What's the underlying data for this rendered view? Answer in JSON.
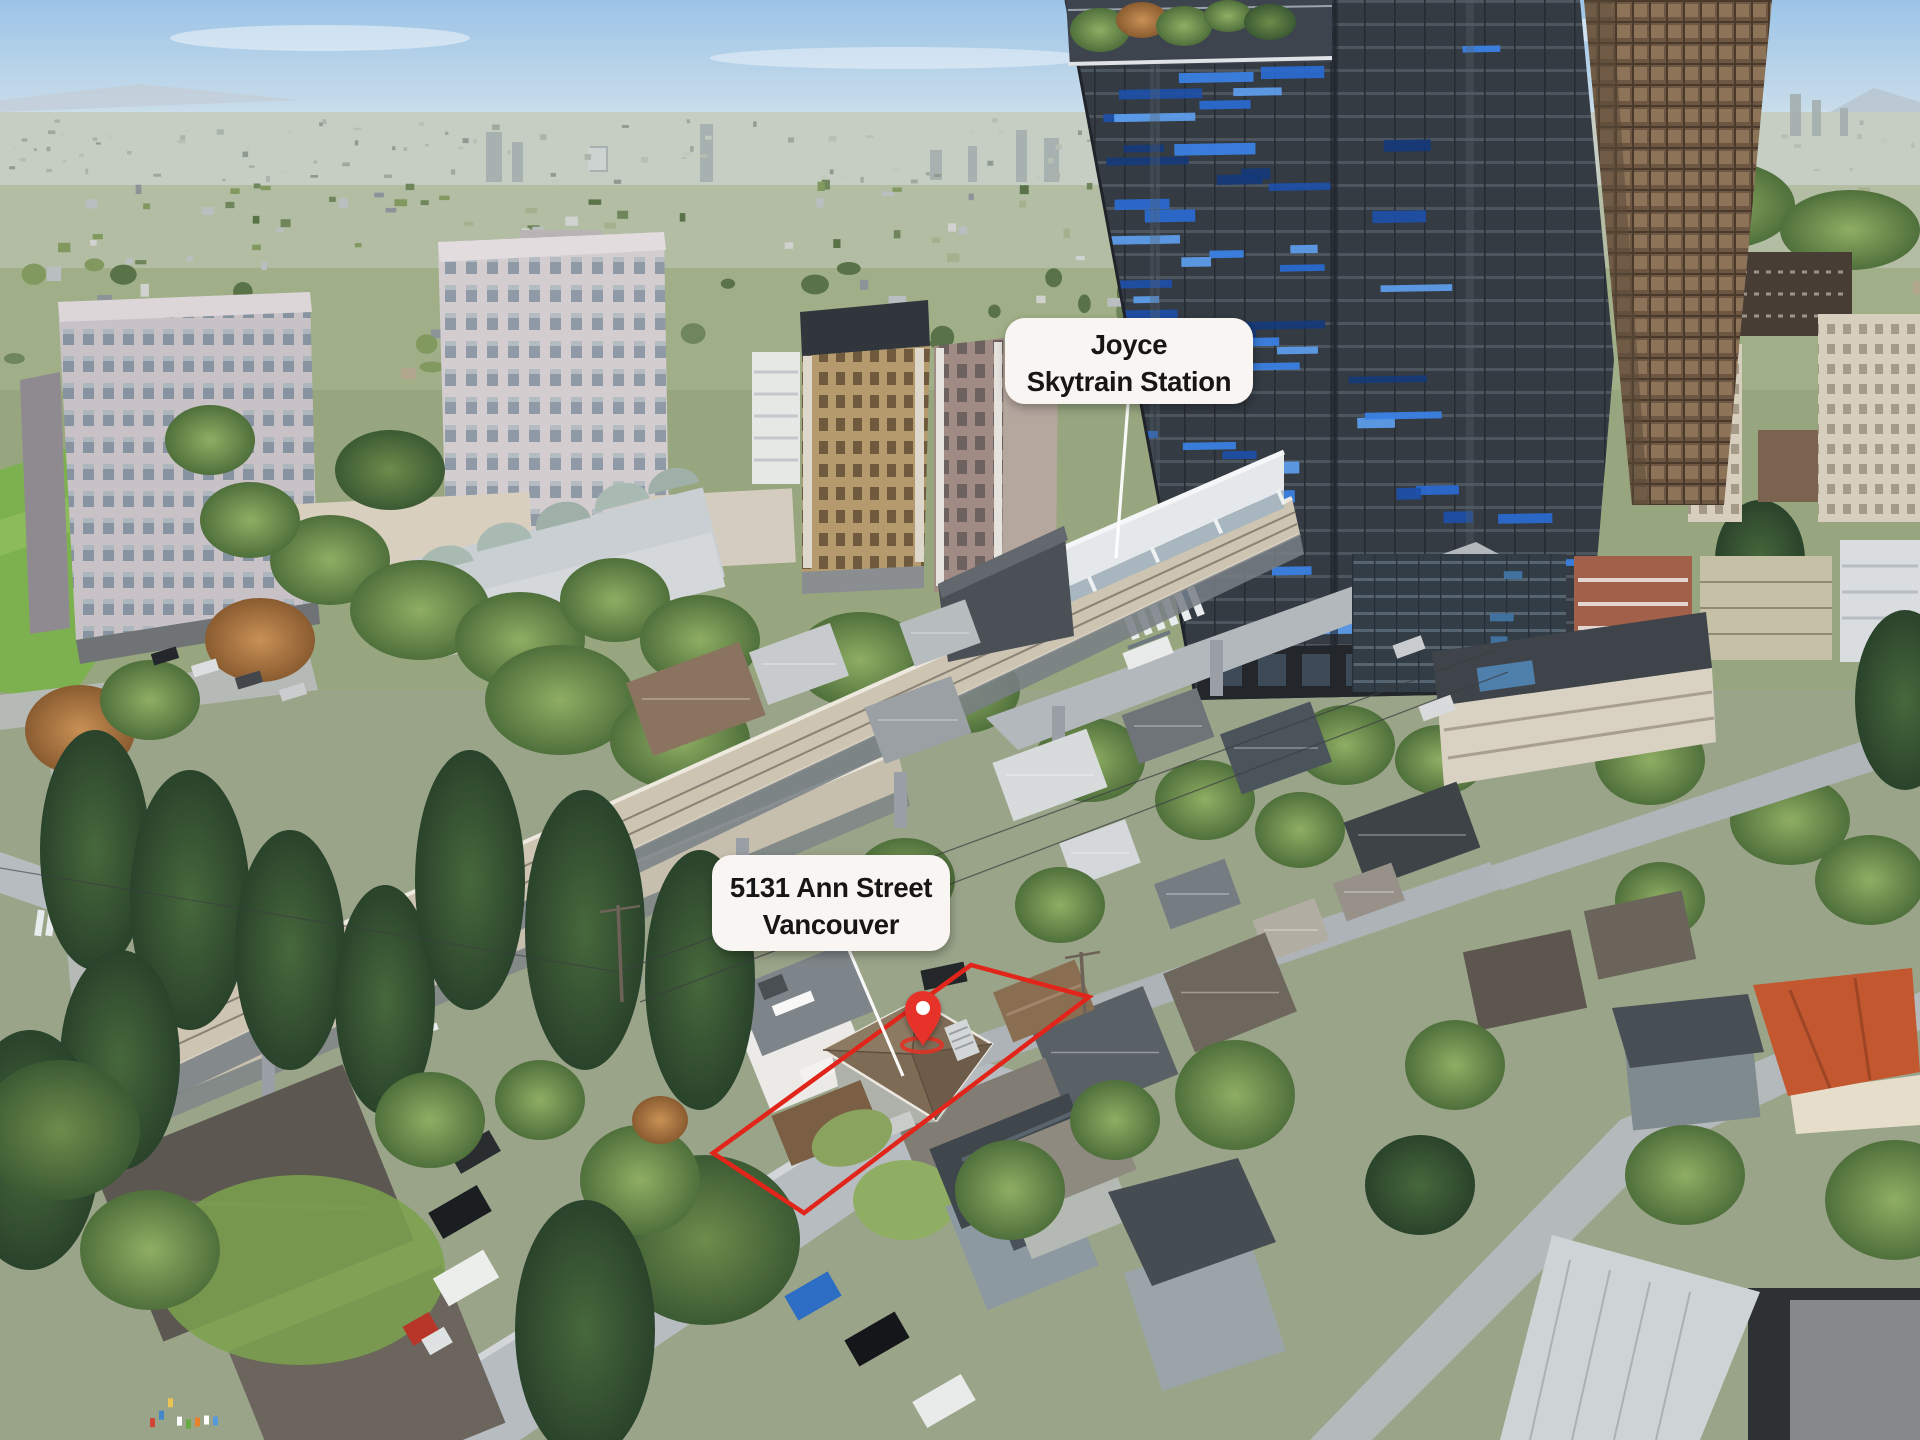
{
  "image_type": "aerial-drone-photo",
  "location_context": "residential neighbourhood with SkyTrain line and high-rise towers",
  "annotations": {
    "station_label": {
      "line1": "Joyce",
      "line2": "Skytrain Station"
    },
    "property_label": {
      "line1": "5131 Ann Street",
      "line2": "Vancouver"
    }
  },
  "markers": {
    "pin_icon": "location-pin-icon",
    "pin_color": "#e73329",
    "pin_ring_color": "#dd3426",
    "outline_color": "#e1251a",
    "pointer_line_color": "#ffffff",
    "label_background": "#f9f5f3",
    "label_text_color": "#181512"
  }
}
